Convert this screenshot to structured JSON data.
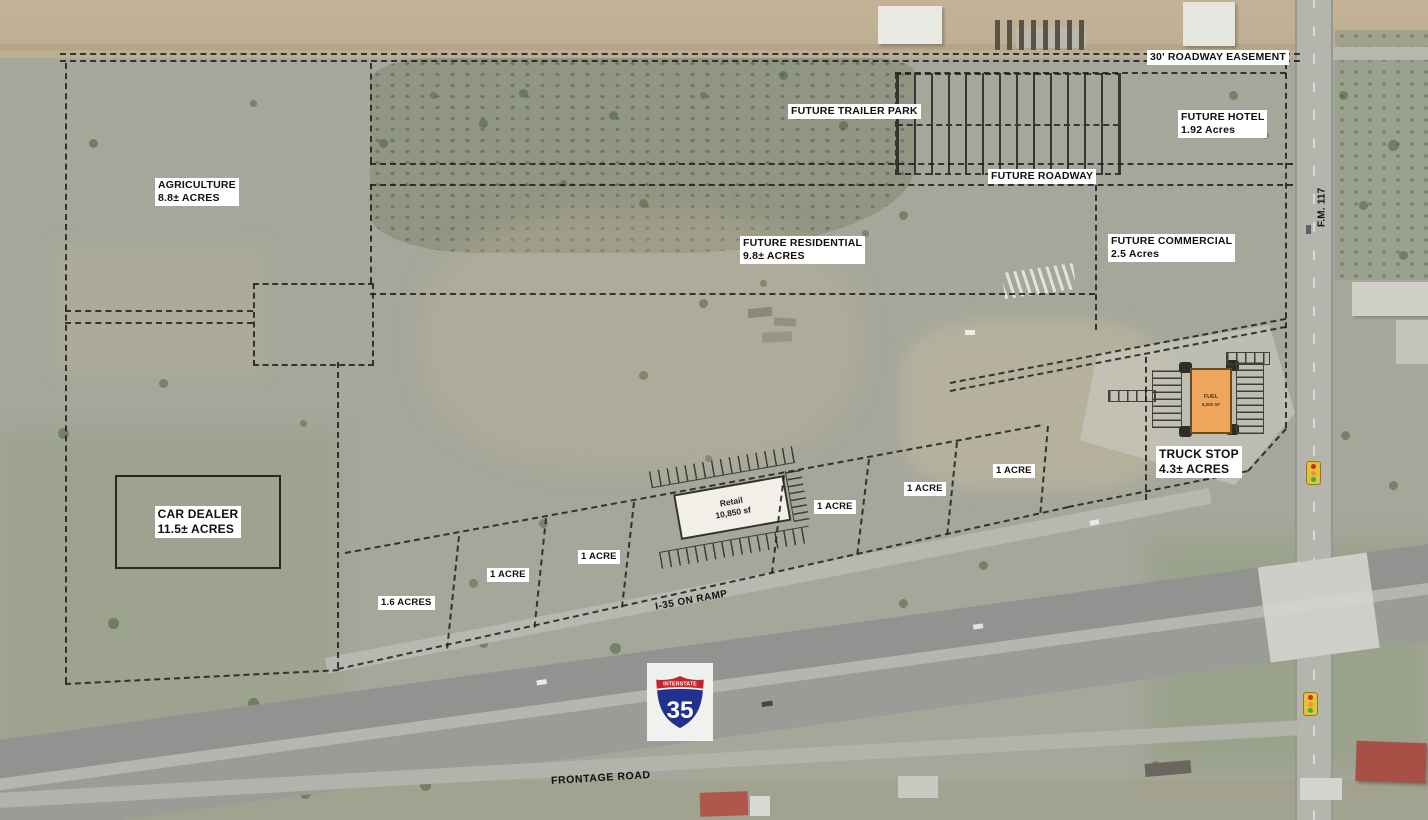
{
  "labels": {
    "roadway_easement": "30' ROADWAY EASEMENT",
    "trailer_park": "FUTURE TRAILER PARK",
    "hotel_name": "FUTURE HOTEL",
    "hotel_acres": "1.92 Acres",
    "agriculture_name": "AGRICULTURE",
    "agriculture_acres": "8.8± ACRES",
    "future_roadway": "FUTURE ROADWAY",
    "residential_name": "FUTURE RESIDENTIAL",
    "residential_acres": "9.8± ACRES",
    "commercial_name": "FUTURE COMMERCIAL",
    "commercial_acres": "2.5 Acres",
    "fm117": "F.M. 117",
    "truck_stop_name": "TRUCK STOP",
    "truck_stop_acres": "4.3± ACRES",
    "car_dealer_name": "CAR DEALER",
    "car_dealer_acres": "11.5± ACRES",
    "on_ramp": "I-35 ON RAMP",
    "frontage_road": "FRONTAGE ROAD"
  },
  "lots": [
    {
      "label": "1.6 ACRES"
    },
    {
      "label": "1 ACRE"
    },
    {
      "label": "1 ACRE"
    },
    {
      "label": "1 ACRE"
    },
    {
      "label": "1 ACRE"
    },
    {
      "label": "1 ACRE"
    }
  ],
  "buildings": {
    "retail_name": "Retail",
    "retail_size": "10,850 sf",
    "fuel_name": "FUEL",
    "fuel_size": "5,000 SF"
  },
  "shield": {
    "top": "INTERSTATE",
    "number": "35"
  },
  "colors": {
    "plan_line": "#1f1f1f",
    "fuel_building": "#f0a55c",
    "shield_blue": "#22308f",
    "shield_red": "#c8222b",
    "label_bg": "#ffffff"
  }
}
